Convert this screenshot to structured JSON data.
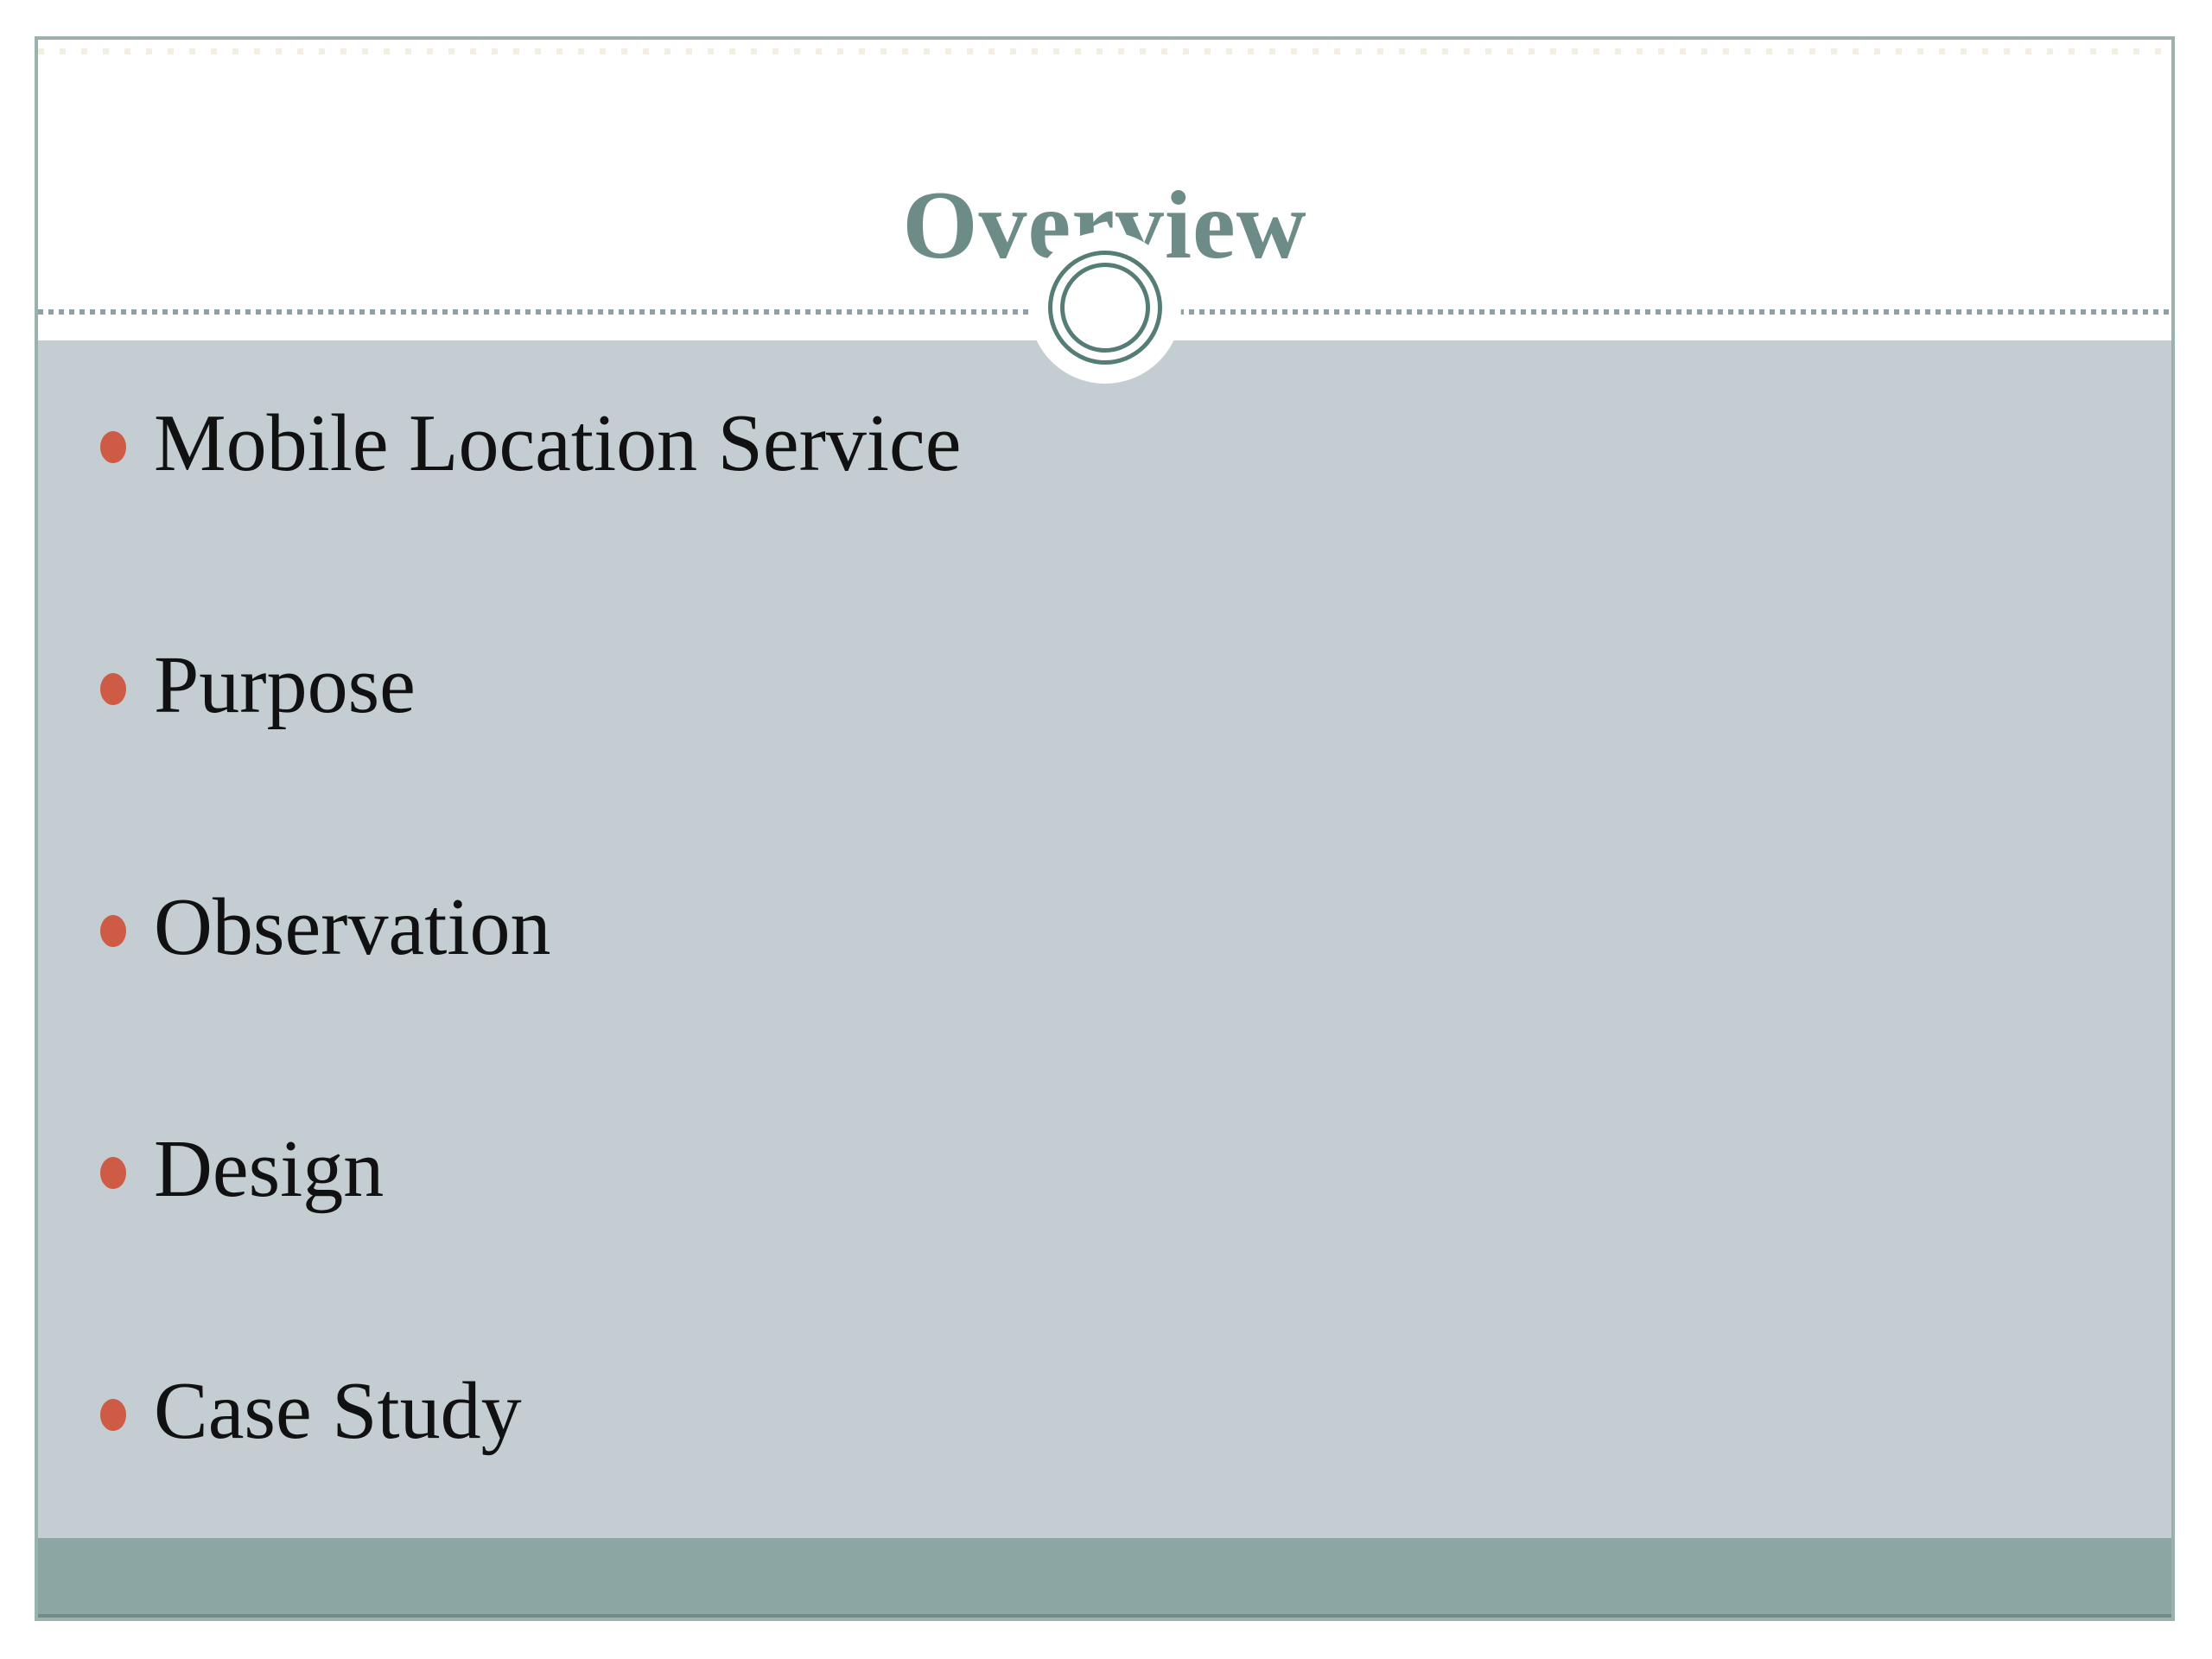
{
  "slide": {
    "title": "Overview",
    "bullets": [
      "Mobile Location Service",
      "Purpose",
      "Observation",
      "Design",
      "Case Study"
    ]
  },
  "ornament": {
    "shape": "double-ring-circle"
  },
  "colors": {
    "title_color": "#6e8c87",
    "text_color": "#111111",
    "bullet_color": "#cd5b45",
    "content_bg": "#c4ced2",
    "band_color": "#8ba6a3",
    "band_edge_color": "#6f8c89",
    "border_color": "#9bb1ae",
    "ring_color": "#557d76",
    "dash_color": "#8ca0a5",
    "faint_dot_color": "#f2eee2"
  }
}
